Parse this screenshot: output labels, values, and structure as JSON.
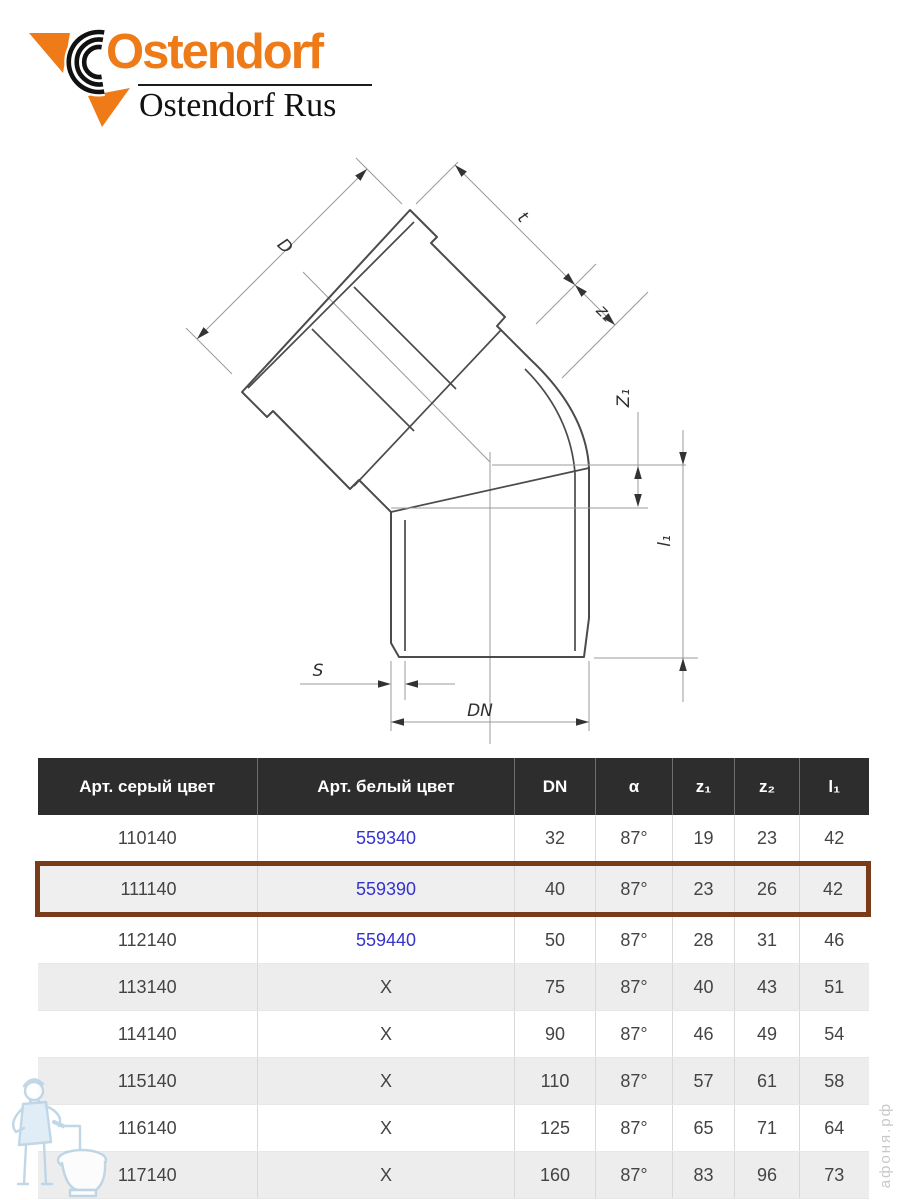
{
  "logo": {
    "brand": "Ostendorf",
    "subtitle": "Ostendorf Rus"
  },
  "drawing": {
    "labels": {
      "d": "D",
      "t": "t",
      "z2": "z₂",
      "z1": "Z₁",
      "l1": "l₁",
      "s": "S",
      "dn": "DN"
    }
  },
  "table": {
    "headers": [
      "Арт. серый цвет",
      "Арт. белый цвет",
      "DN",
      "α",
      "z₁",
      "z₂",
      "l₁"
    ],
    "rows": [
      {
        "grey": "110140",
        "white": "559340",
        "dn": "32",
        "alpha": "87°",
        "z1": "19",
        "z2": "23",
        "l1": "42"
      },
      {
        "grey": "111140",
        "white": "559390",
        "dn": "40",
        "alpha": "87°",
        "z1": "23",
        "z2": "26",
        "l1": "42"
      },
      {
        "grey": "112140",
        "white": "559440",
        "dn": "50",
        "alpha": "87°",
        "z1": "28",
        "z2": "31",
        "l1": "46"
      },
      {
        "grey": "113140",
        "white": "X",
        "dn": "75",
        "alpha": "87°",
        "z1": "40",
        "z2": "43",
        "l1": "51"
      },
      {
        "grey": "114140",
        "white": "X",
        "dn": "90",
        "alpha": "87°",
        "z1": "46",
        "z2": "49",
        "l1": "54"
      },
      {
        "grey": "115140",
        "white": "X",
        "dn": "110",
        "alpha": "87°",
        "z1": "57",
        "z2": "61",
        "l1": "58"
      },
      {
        "grey": "116140",
        "white": "X",
        "dn": "125",
        "alpha": "87°",
        "z1": "65",
        "z2": "71",
        "l1": "64"
      },
      {
        "grey": "117140",
        "white": "X",
        "dn": "160",
        "alpha": "87°",
        "z1": "83",
        "z2": "96",
        "l1": "73"
      }
    ],
    "highlighted_row": "111140"
  },
  "watermark": {
    "site": "афоня.рф"
  },
  "colors": {
    "accent_orange": "#ee7b17",
    "link_blue": "#3533cd",
    "highlight_border": "#7a3b1a",
    "header_bg": "#2d2d2d",
    "row_alt_bg": "#ededed"
  }
}
